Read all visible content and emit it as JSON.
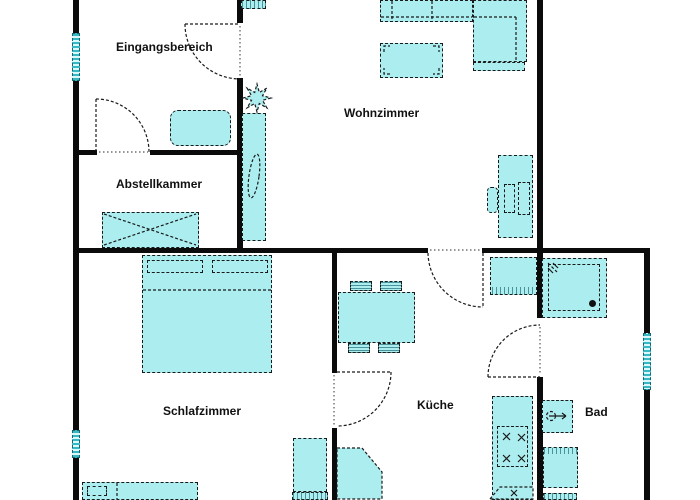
{
  "rooms": {
    "eingangsbereich": {
      "label": "Eingangsbereich"
    },
    "abstellkammer": {
      "label": "Abstellkammer"
    },
    "wohnzimmer": {
      "label": "Wohnzimmer"
    },
    "schlafzimmer": {
      "label": "Schlafzimmer"
    },
    "kueche": {
      "label": "Küche"
    },
    "bad": {
      "label": "Bad"
    }
  },
  "colors": {
    "background": "#ffffff",
    "wall": "#0b0b0b",
    "furniture_fill": "#aceef0",
    "furniture_border": "#1a1a1a",
    "window_stripe": "#38b8c4"
  },
  "icons": {
    "plant_icon": "✳",
    "stove_burner_icon": "✕",
    "sink_faucet_icon": "✕",
    "shower_drain_icon": "●"
  }
}
